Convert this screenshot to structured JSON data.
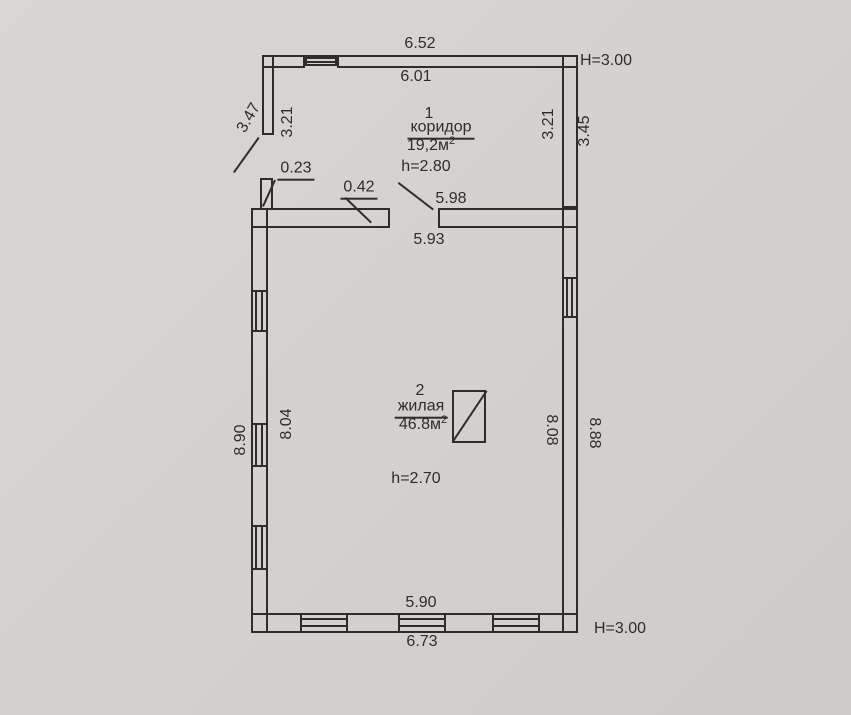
{
  "document": {
    "type": "floor-plan-scan",
    "background_color": "#d4d2d0",
    "line_color": "#2f2d2a"
  },
  "rooms": [
    {
      "number": "1",
      "name": "коридор",
      "area": "19,2м",
      "area_sup": "2",
      "ceiling_height": "h=2.80"
    },
    {
      "number": "2",
      "name": "жилая",
      "area": "46.8м",
      "area_sup": "2",
      "ceiling_height": "h=2.70"
    }
  ],
  "dimensions": {
    "top_outer": "6.52",
    "top_inner": "6.01",
    "top_building_height": "H=3.00",
    "corridor_left_outer": "3.47",
    "corridor_left_inner": "3.21",
    "corridor_right_inner": "3.21",
    "corridor_right_outer": "3.45",
    "stub_width": "0.23",
    "wall_thickness": "0.42",
    "mid_wall_right": "5.98",
    "mid_wall_inner": "5.93",
    "left_outer": "8.90",
    "left_inner": "8.04",
    "right_inner": "8.08",
    "right_outer": "8.88",
    "bottom_inner": "5.90",
    "bottom_outer": "6.73",
    "bottom_building_height": "H=3.00"
  }
}
